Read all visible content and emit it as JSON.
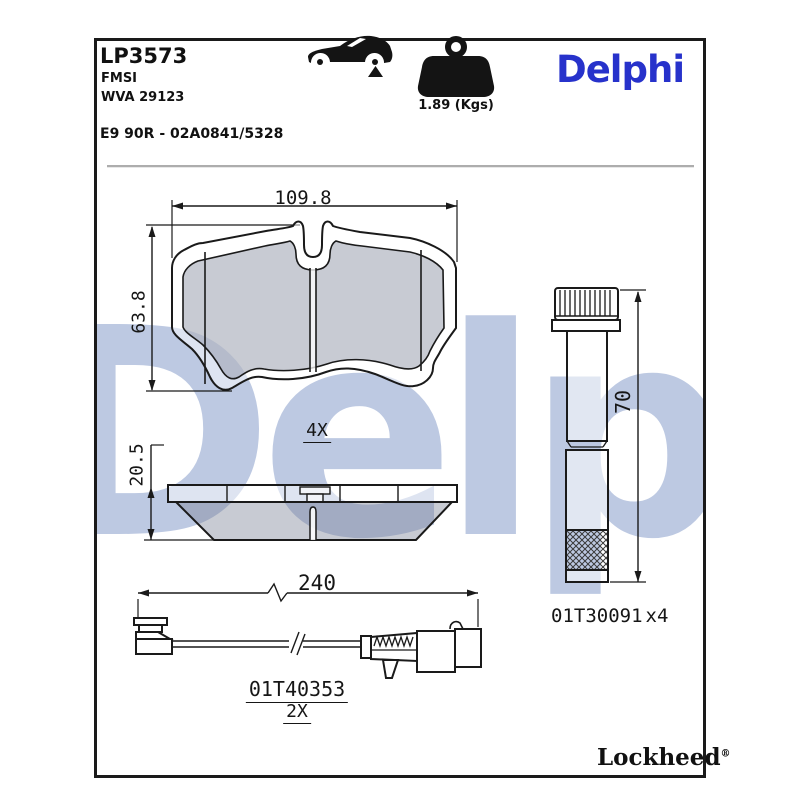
{
  "header": {
    "part_number": "LP3573",
    "fmsi_label": "FMSI",
    "wva_label": "WVA 29123",
    "homologation": "E9 90R - 02A0841/5328",
    "weight_label": "1.89 (Kgs)",
    "brand": "Delphi"
  },
  "icons": {
    "car": "car-side-silhouette-rear-axle-marker",
    "weight": "kettlebell-weight"
  },
  "watermark": {
    "text": "Delphi"
  },
  "front_view": {
    "width_dim": "109.8",
    "height_dim": "63.8",
    "qty_label": "4X"
  },
  "side_view": {
    "thickness_dim": "20.5"
  },
  "sensor": {
    "length_dim": "240",
    "part_number": "01T40353",
    "qty_label": "2X"
  },
  "bolt": {
    "length_dim": "70",
    "part_number": "01T30091",
    "qty_label": "x4"
  },
  "footer": {
    "logo_text": "Lockheed",
    "registered_mark": "®"
  },
  "colors": {
    "brand_blue": "#2732cb",
    "watermark_blue": "#bdc9e2",
    "line_color": "#1a1a1a",
    "fill_gray": "#7d8496",
    "divider_gray": "#adadad"
  }
}
